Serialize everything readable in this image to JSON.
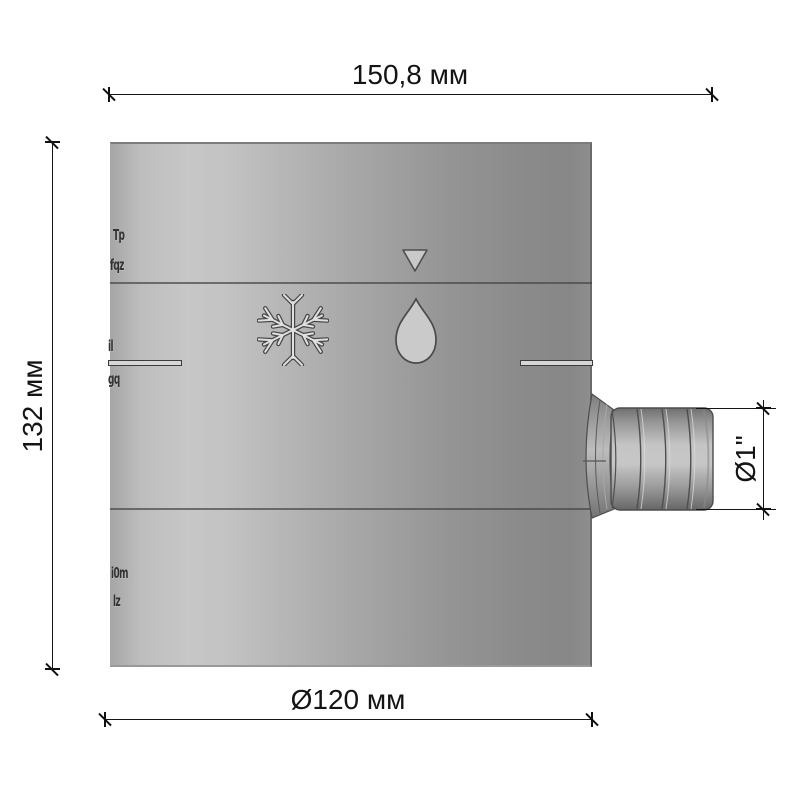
{
  "labels": {
    "width": "150,8 мм",
    "height": "132 мм",
    "diameter": "Ø120 мм",
    "outlet": "Ø1\""
  },
  "embossed": {
    "a": "Tp",
    "b": "fqz",
    "c": "il",
    "d": "gq",
    "e": "i0m",
    "f": "lz"
  },
  "icons": {
    "triangle": "triangle-down",
    "snow": "snowflake",
    "drop": "water-drop"
  },
  "colors": {
    "body_highlight": "#c6c6c6",
    "body_shadow": "#8a8a8a",
    "dim_line": "#141414"
  }
}
